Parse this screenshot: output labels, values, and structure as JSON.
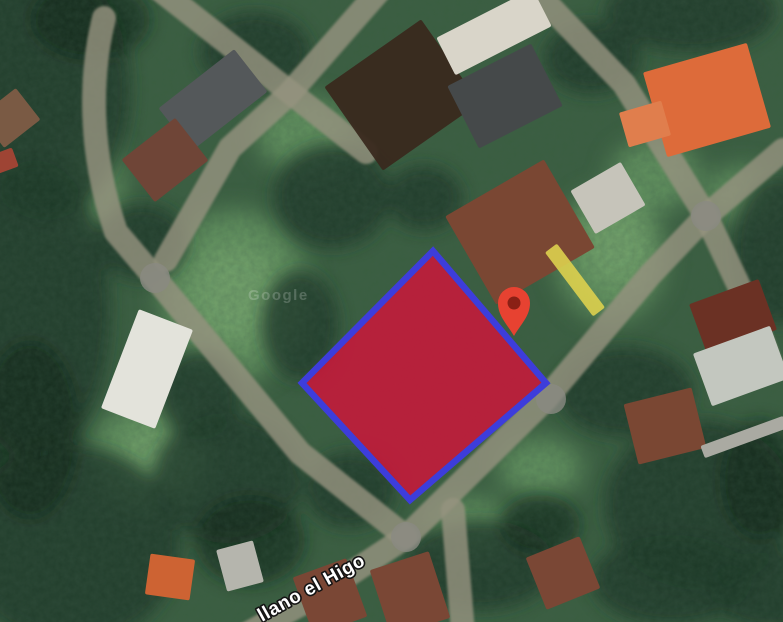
{
  "map": {
    "view_type": "satellite",
    "street_label": {
      "text": "llano el Higo",
      "x": 262,
      "y": 622,
      "rotation": -29,
      "color": "#ffffff",
      "outline": "#141414"
    },
    "watermark": {
      "text": "Google",
      "x": 248,
      "y": 300,
      "opacity": 0.2,
      "color": "#ffffff"
    },
    "plot": {
      "points": [
        [
          433,
          251
        ],
        [
          546,
          383
        ],
        [
          410,
          500
        ],
        [
          302,
          383
        ]
      ],
      "fill": "#d6113a",
      "fill_opacity": 0.8,
      "stroke": "#3d3ddb",
      "stroke_width": 6.5
    },
    "pin": {
      "x": 514,
      "tip_y": 336,
      "color": "#e74231",
      "dot_color": "#8a2015"
    },
    "roads": {
      "color": "#95927f",
      "opacity": 0.82,
      "width": 24,
      "node_color": "#8a8a82",
      "node_radius": 15,
      "junction_nodes": [
        [
          155,
          278
        ],
        [
          406,
          537
        ],
        [
          551,
          399
        ],
        [
          706,
          216
        ]
      ],
      "paths": [
        {
          "name": "road-west-curve",
          "d": "M 104 18 C 90 75 88 150 116 232 L 155 278 L 300 453 L 406 537"
        },
        {
          "name": "road-southeast-diagonal",
          "d": "M 406 537 L 545 400 L 650 275 L 706 216 L 783 150"
        },
        {
          "name": "road-southwest-branch",
          "d": "M 406 537 L 318 595 L 245 635"
        },
        {
          "name": "road-south-branch",
          "d": "M 453 510 L 463 632"
        },
        {
          "name": "road-north-a",
          "d": "M 160 -10 L 310 108 L 366 152"
        },
        {
          "name": "road-north-b",
          "d": "M 380 -10 L 288 95 L 230 148 L 166 260"
        },
        {
          "name": "road-northeast",
          "d": "M 534 -10 L 624 84 L 706 216"
        },
        {
          "name": "road-east-exit",
          "d": "M 706 216 L 754 318 L 772 368"
        }
      ]
    },
    "terrain": {
      "base_color": "#3b5f41",
      "grass_color": "#6b9d66",
      "grass_highlight": "#83b075",
      "tree_color": "#1f3828",
      "tree_accent": "#142a1c",
      "grass_patches": [
        [
          235,
          295,
          75,
          85
        ],
        [
          150,
          455,
          60,
          55
        ],
        [
          610,
          255,
          55,
          65
        ],
        [
          655,
          175,
          45,
          35
        ],
        [
          470,
          528,
          45,
          30
        ],
        [
          305,
          135,
          48,
          38
        ],
        [
          95,
          185,
          28,
          55
        ],
        [
          540,
          468,
          42,
          30
        ],
        [
          742,
          195,
          38,
          28
        ]
      ],
      "grass_highlights": [
        [
          235,
          295,
          45,
          50
        ],
        [
          618,
          248,
          35,
          40
        ],
        [
          155,
          458,
          35,
          30
        ]
      ],
      "tree_patches": [
        [
          45,
          90,
          85,
          130
        ],
        [
          35,
          310,
          75,
          150
        ],
        [
          70,
          545,
          110,
          100
        ],
        [
          255,
          52,
          55,
          40
        ],
        [
          332,
          196,
          58,
          52
        ],
        [
          300,
          325,
          38,
          55
        ],
        [
          228,
          478,
          75,
          65
        ],
        [
          350,
          490,
          45,
          38
        ],
        [
          480,
          565,
          75,
          45
        ],
        [
          625,
          392,
          68,
          45
        ],
        [
          700,
          505,
          95,
          85
        ],
        [
          778,
          250,
          45,
          75
        ],
        [
          592,
          58,
          48,
          36
        ],
        [
          424,
          198,
          38,
          32
        ],
        [
          142,
          242,
          45,
          38
        ],
        [
          672,
          580,
          80,
          45
        ],
        [
          200,
          395,
          40,
          45
        ],
        [
          770,
          590,
          60,
          40
        ],
        [
          690,
          12,
          85,
          40
        ]
      ],
      "tree_accents": [
        [
          30,
          430,
          50,
          90
        ],
        [
          250,
          540,
          55,
          45
        ],
        [
          90,
          20,
          60,
          40
        ],
        [
          760,
          480,
          40,
          60
        ],
        [
          540,
          525,
          40,
          30
        ]
      ]
    },
    "buildings": [
      {
        "name": "dirt-lot",
        "cx": 402,
        "cy": 95,
        "w": 118,
        "h": 102,
        "rot": -35,
        "color": "#39291e",
        "opacity": 0.95
      },
      {
        "name": "house-gray-roof-nw",
        "cx": 213,
        "cy": 100,
        "w": 96,
        "h": 54,
        "rot": -38,
        "color": "#54585a"
      },
      {
        "name": "house-brown-roof-nw",
        "cx": 165,
        "cy": 160,
        "w": 68,
        "h": 54,
        "rot": -38,
        "color": "#6f4537"
      },
      {
        "name": "shed-left-edge",
        "cx": 10,
        "cy": 118,
        "w": 46,
        "h": 40,
        "rot": -38,
        "color": "#7a5a44"
      },
      {
        "name": "shed-left-edge-red",
        "cx": 4,
        "cy": 161,
        "w": 24,
        "h": 20,
        "rot": -20,
        "color": "#9e4434"
      },
      {
        "name": "building-white-top",
        "cx": 494,
        "cy": 32,
        "w": 108,
        "h": 42,
        "rot": -27,
        "color": "#d9d5c9"
      },
      {
        "name": "building-darkgray-top",
        "cx": 505,
        "cy": 96,
        "w": 94,
        "h": 70,
        "rot": -27,
        "color": "#45494a"
      },
      {
        "name": "building-white-mid",
        "cx": 608,
        "cy": 198,
        "w": 58,
        "h": 50,
        "rot": -30,
        "color": "#c6c4ba"
      },
      {
        "name": "house-big-brown-roof",
        "cx": 520,
        "cy": 232,
        "w": 114,
        "h": 102,
        "rot": -30,
        "color": "#7a4733"
      },
      {
        "name": "house-orange-roof-ne",
        "cx": 707,
        "cy": 100,
        "w": 108,
        "h": 88,
        "rot": -16,
        "color": "#dd6b3a"
      },
      {
        "name": "house-orange-wing-ne",
        "cx": 645,
        "cy": 124,
        "w": 44,
        "h": 36,
        "rot": -16,
        "color": "#e07e4d"
      },
      {
        "name": "strip-yellow-path",
        "cx": 575,
        "cy": 280,
        "w": 15,
        "h": 80,
        "rot": -37,
        "color": "#ddd04e",
        "opacity": 0.9
      },
      {
        "name": "shed-rust-roof-e",
        "cx": 733,
        "cy": 317,
        "w": 74,
        "h": 54,
        "rot": -20,
        "color": "#6b3124"
      },
      {
        "name": "shed-metal-roof-e",
        "cx": 741,
        "cy": 366,
        "w": 82,
        "h": 56,
        "rot": -20,
        "color": "#c3c7bf"
      },
      {
        "name": "house-brown-roof-e",
        "cx": 665,
        "cy": 426,
        "w": 70,
        "h": 62,
        "rot": -14,
        "color": "#7a4733"
      },
      {
        "name": "building-white-roof-w",
        "cx": 147,
        "cy": 369,
        "w": 58,
        "h": 106,
        "rot": 21,
        "color": "#e3e3db"
      },
      {
        "name": "house-orange-roof-sw",
        "cx": 170,
        "cy": 577,
        "w": 45,
        "h": 41,
        "rot": 8,
        "color": "#cd6333"
      },
      {
        "name": "shed-white-roof-sw",
        "cx": 240,
        "cy": 566,
        "w": 38,
        "h": 43,
        "rot": -15,
        "color": "#b5b5ad"
      },
      {
        "name": "house-brown-roof-s1",
        "cx": 330,
        "cy": 597,
        "w": 57,
        "h": 62,
        "rot": -20,
        "color": "#7a4735"
      },
      {
        "name": "house-brown-roof-s2",
        "cx": 410,
        "cy": 594,
        "w": 62,
        "h": 70,
        "rot": -18,
        "color": "#7a4735"
      },
      {
        "name": "house-brown-roof-s3",
        "cx": 563,
        "cy": 573,
        "w": 58,
        "h": 56,
        "rot": -22,
        "color": "#7a4735"
      },
      {
        "name": "strip-pale-roof-se",
        "cx": 744,
        "cy": 437,
        "w": 88,
        "h": 13,
        "rot": -20,
        "color": "#aaaaa2"
      }
    ]
  }
}
